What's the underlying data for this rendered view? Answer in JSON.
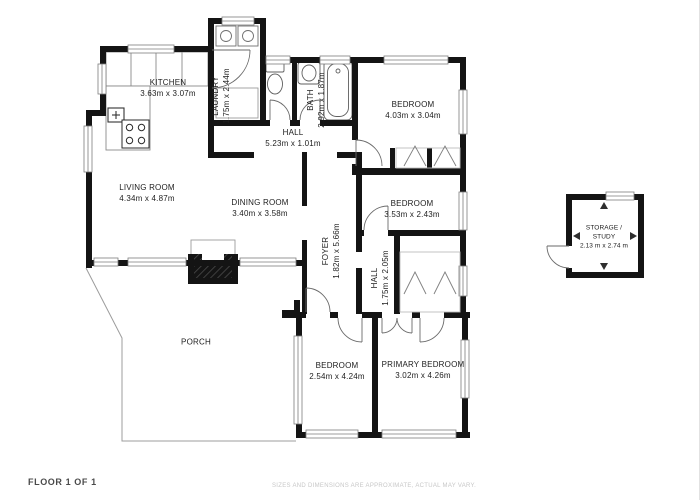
{
  "footer": {
    "floor_label": "FLOOR 1 OF 1",
    "disclaimer": "SIZES AND DIMENSIONS ARE APPROXIMATE, ACTUAL MAY VARY."
  },
  "rooms": [
    {
      "id": "kitchen",
      "name": "KITCHEN",
      "dims": "3.63m x 3.07m"
    },
    {
      "id": "laundry",
      "name": "LAUNDRY",
      "dims": "1.75m x 2.44m"
    },
    {
      "id": "bath",
      "name": "BATH",
      "dims": "2.92m x 1.87m"
    },
    {
      "id": "bedroom-top",
      "name": "BEDROOM",
      "dims": "4.03m x 3.04m"
    },
    {
      "id": "hall-upper",
      "name": "HALL",
      "dims": "5.23m x 1.01m"
    },
    {
      "id": "living-room",
      "name": "LIVING ROOM",
      "dims": "4.34m x 4.87m"
    },
    {
      "id": "dining-room",
      "name": "DINING ROOM",
      "dims": "3.40m x 3.58m"
    },
    {
      "id": "bedroom-middle",
      "name": "BEDROOM",
      "dims": "3.53m x 2.43m"
    },
    {
      "id": "foyer",
      "name": "FOYER",
      "dims": "1.82m x 5.66m"
    },
    {
      "id": "hall-lower",
      "name": "HALL",
      "dims": "1.75m x 2.05m"
    },
    {
      "id": "porch",
      "name": "PORCH",
      "dims": ""
    },
    {
      "id": "bedroom-bottom",
      "name": "BEDROOM",
      "dims": "2.54m x 4.24m"
    },
    {
      "id": "primary-bedroom",
      "name": "PRIMARY BEDROOM",
      "dims": "3.02m x 4.26m"
    },
    {
      "id": "storage-study",
      "name": "STORAGE / STUDY",
      "dims": "2.13 m x 2.74 m"
    }
  ]
}
